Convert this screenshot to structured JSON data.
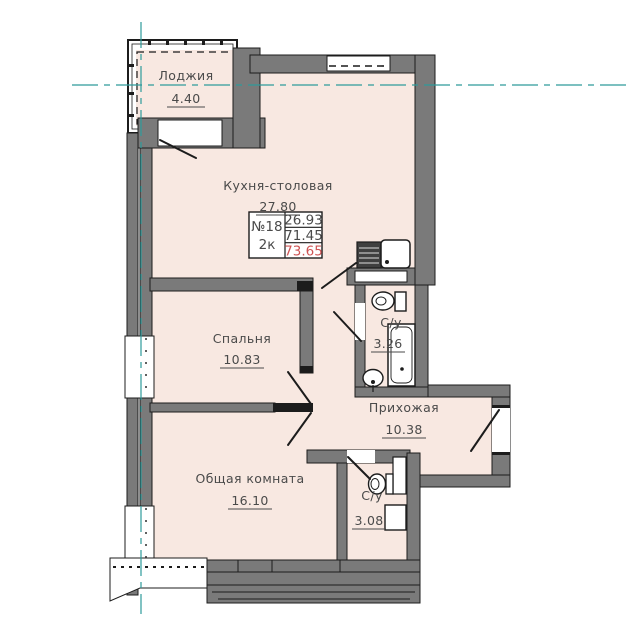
{
  "plan": {
    "unit": {
      "number": "№18",
      "type": "2к",
      "area_living": "26.93",
      "area_main": "71.45",
      "area_total": "73.65"
    },
    "rooms": {
      "loggia": {
        "name": "Лоджия",
        "area": "4.40"
      },
      "kitchen": {
        "name": "Кухня-столовая",
        "area": "27.80"
      },
      "bedroom": {
        "name": "Спальня",
        "area": "10.83"
      },
      "bathroom_top": {
        "name": "С/у",
        "area": "3.26"
      },
      "hallway": {
        "name": "Прихожая",
        "area": "10.38"
      },
      "living_room": {
        "name": "Общая комната",
        "area": "16.10"
      },
      "bathroom_bottom": {
        "name": "С/у",
        "area": "3.08"
      }
    },
    "colors": {
      "floor_fill": "#f8e8e1",
      "wall_gray": "#7a7a7a",
      "outline": "#1c1c1c",
      "axis_teal": "#2e9b9b",
      "total_highlight": "#cf5454",
      "label_text": "#4a4a4a"
    }
  }
}
